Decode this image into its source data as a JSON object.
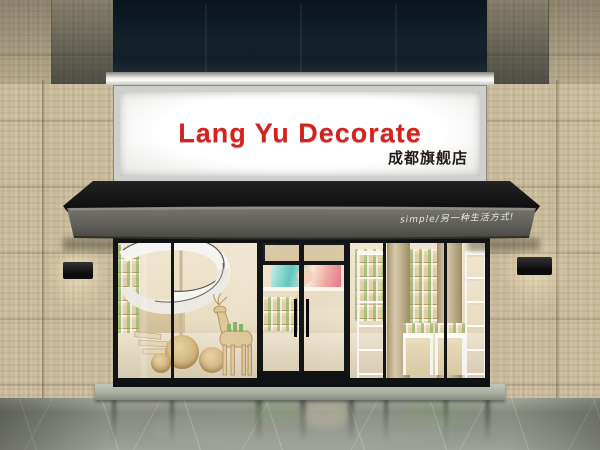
{
  "scene_label": "storefront-render",
  "sign": {
    "title": "Lang Yu Decorate",
    "subtitle": "成都旗舰店"
  },
  "awning": {
    "slogan": "simple/另一种生活方式!"
  },
  "palette": {
    "sign_red": "#d2231f",
    "sign_panel": "#f5f5f2",
    "awning_black": "#141414",
    "awning_fascia": "#5d5c56",
    "upper_glass_navy": "#13202b",
    "tile_beige": "#c9bc9c",
    "frame_black": "#17181a",
    "interior_warm": "#e9dec4",
    "wood_tan": "#d9c08f",
    "product_green": "#7cab5a",
    "floor_gray": "#8d9187"
  }
}
